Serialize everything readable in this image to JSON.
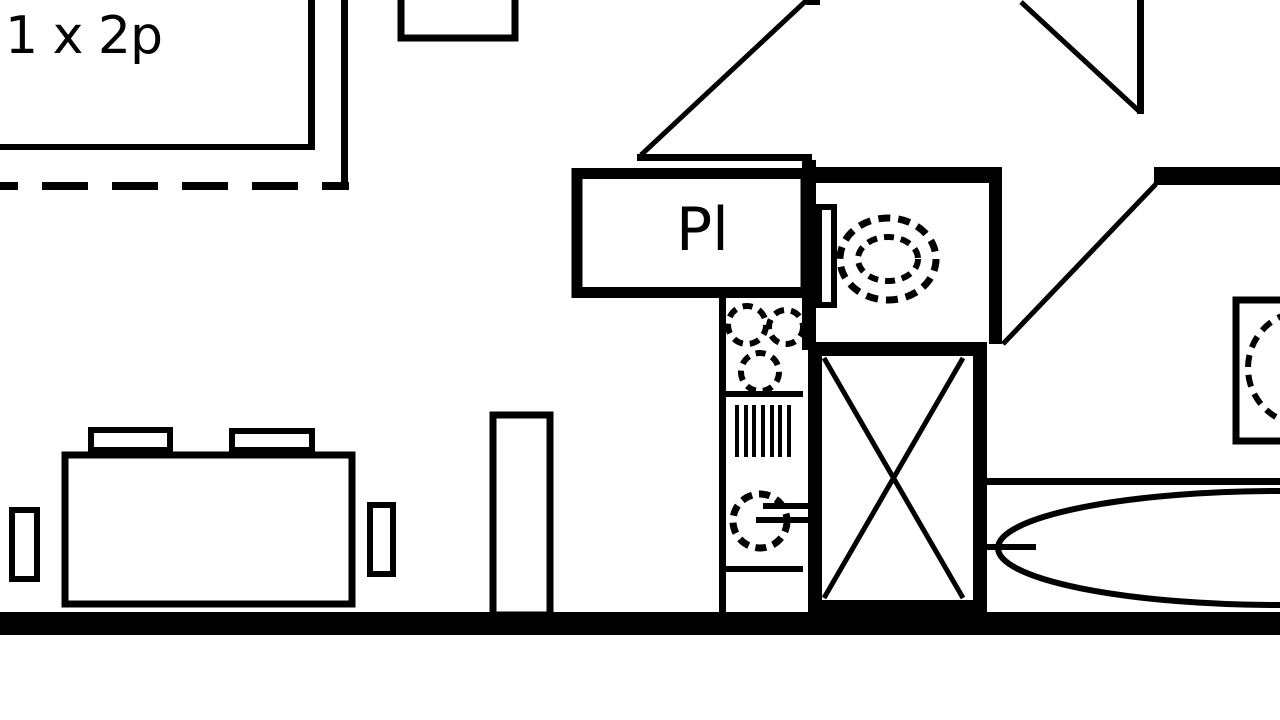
{
  "colors": {
    "ink": "#000000",
    "paper": "#ffffff"
  },
  "labels": {
    "unit_capacity": "1 x 2p",
    "closet": "Pl"
  },
  "symbols": [
    {
      "name": "balcony-dashed-boundary"
    },
    {
      "name": "door-swing",
      "count": 3
    },
    {
      "name": "toilet"
    },
    {
      "name": "shower-crossed-box"
    },
    {
      "name": "bathtub"
    },
    {
      "name": "washbasin"
    },
    {
      "name": "stove-burner",
      "count": 3
    },
    {
      "name": "drainer-grill"
    },
    {
      "name": "kitchen-sink"
    },
    {
      "name": "dining-table"
    },
    {
      "name": "chair",
      "count": 4
    }
  ]
}
